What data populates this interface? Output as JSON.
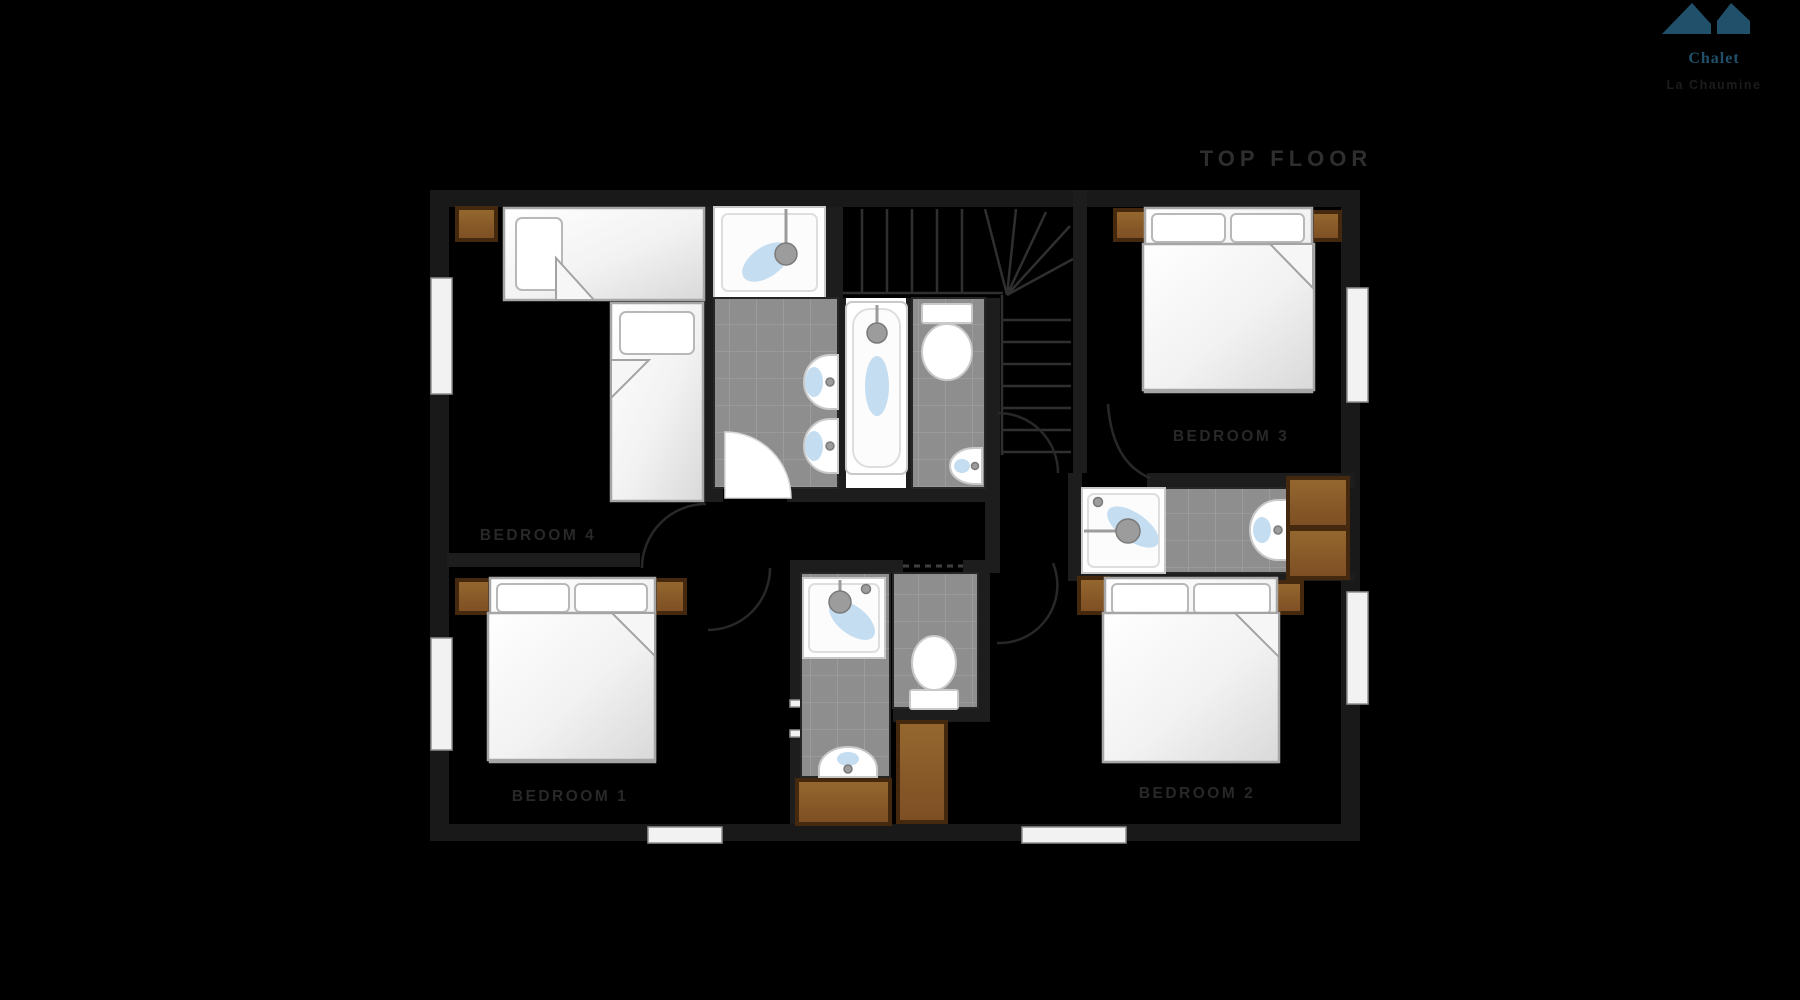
{
  "title": "TOP FLOOR",
  "logo": {
    "line1": "Chalet",
    "line2": "La Chaumine",
    "icon": "mountain-logo-icon"
  },
  "rooms": {
    "bedroom1": {
      "label": "BEDROOM 1"
    },
    "bedroom2": {
      "label": "BEDROOM 2"
    },
    "bedroom3": {
      "label": "BEDROOM 3"
    },
    "bedroom4": {
      "label": "BEDROOM 4"
    }
  },
  "fixtures": [
    "double-bed",
    "single-bed",
    "nightstand",
    "wardrobe",
    "shower",
    "bathtub",
    "toilet",
    "sink",
    "staircase",
    "door",
    "window"
  ],
  "colors": {
    "background": "#000000",
    "wall": "#191919",
    "innerWall": "#1d1d1d",
    "tile": "#8e8e8e",
    "grout": "#9f9f9f",
    "fixtureWhite": "#ffffff",
    "fixtureStroke": "#c9c9c9",
    "water": "#c5ddf0",
    "metal": "#9c9c9c",
    "wood": "#8a5a2d",
    "woodEdge": "#44290f",
    "bedStroke": "#a6a6a6",
    "stair": "#2f2f2f",
    "door": "#282828",
    "label": "#282828",
    "title": "#2e2e2e",
    "logoTeal": "#20506a"
  }
}
